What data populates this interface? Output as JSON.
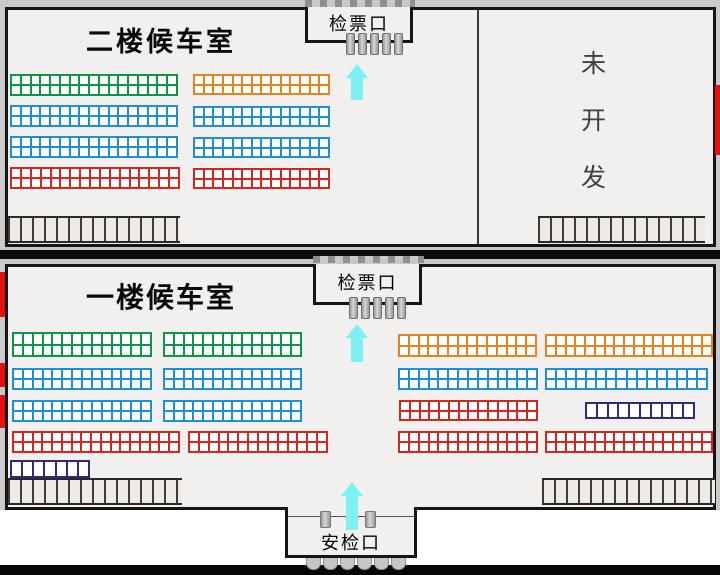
{
  "colors": {
    "green": "#0a9848",
    "orange": "#e7831c",
    "blue": "#1c8fd6",
    "red": "#d7261f",
    "purple": "#33297f",
    "cyan_arrow": "#7df1f1",
    "exit_red": "#e51010",
    "floor_bg": "#f1f0ee",
    "wall": "#151515"
  },
  "icons": {
    "direction": "up-arrow-icon",
    "turnstile": "turnstile-pillar-icon",
    "stairs": "stairs-hatch-icon"
  },
  "floor2": {
    "title": "二楼候车室",
    "gate": {
      "label": "检票口",
      "turnstiles": 5
    },
    "undeveloped": [
      "未",
      "开",
      "发"
    ],
    "seat_groups": [
      {
        "color": "green",
        "x": 10,
        "y": 74,
        "w": 168,
        "h": 22,
        "cols": 17,
        "rows": 2
      },
      {
        "color": "orange",
        "x": 193,
        "y": 74,
        "w": 137,
        "h": 21,
        "cols": 14,
        "rows": 2
      },
      {
        "color": "blue",
        "x": 10,
        "y": 105,
        "w": 168,
        "h": 22,
        "cols": 17,
        "rows": 2
      },
      {
        "color": "blue",
        "x": 193,
        "y": 106,
        "w": 137,
        "h": 21,
        "cols": 14,
        "rows": 2
      },
      {
        "color": "blue",
        "x": 10,
        "y": 136,
        "w": 168,
        "h": 22,
        "cols": 17,
        "rows": 2
      },
      {
        "color": "blue",
        "x": 193,
        "y": 137,
        "w": 137,
        "h": 21,
        "cols": 14,
        "rows": 2
      },
      {
        "color": "red",
        "x": 10,
        "y": 167,
        "w": 170,
        "h": 22,
        "cols": 17,
        "rows": 2
      },
      {
        "color": "red",
        "x": 193,
        "y": 168,
        "w": 137,
        "h": 21,
        "cols": 14,
        "rows": 2
      }
    ]
  },
  "floor1": {
    "title": "一楼候车室",
    "gate": {
      "label": "检票口",
      "turnstiles": 5
    },
    "security": {
      "label": "安检口",
      "pillars": 2,
      "scallops": 6
    },
    "seat_groups": [
      {
        "color": "green",
        "x": 12,
        "y": 332,
        "w": 140,
        "h": 25,
        "cols": 14,
        "rows": 2
      },
      {
        "color": "green",
        "x": 163,
        "y": 332,
        "w": 139,
        "h": 25,
        "cols": 14,
        "rows": 2
      },
      {
        "color": "orange",
        "x": 398,
        "y": 334,
        "w": 139,
        "h": 23,
        "cols": 14,
        "rows": 2
      },
      {
        "color": "orange",
        "x": 545,
        "y": 334,
        "w": 168,
        "h": 23,
        "cols": 17,
        "rows": 2
      },
      {
        "color": "blue",
        "x": 12,
        "y": 368,
        "w": 140,
        "h": 22,
        "cols": 14,
        "rows": 2
      },
      {
        "color": "blue",
        "x": 163,
        "y": 368,
        "w": 139,
        "h": 22,
        "cols": 14,
        "rows": 2
      },
      {
        "color": "blue",
        "x": 398,
        "y": 368,
        "w": 140,
        "h": 22,
        "cols": 14,
        "rows": 2
      },
      {
        "color": "blue",
        "x": 545,
        "y": 368,
        "w": 163,
        "h": 22,
        "cols": 16,
        "rows": 2
      },
      {
        "color": "blue",
        "x": 12,
        "y": 400,
        "w": 140,
        "h": 22,
        "cols": 14,
        "rows": 2
      },
      {
        "color": "blue",
        "x": 163,
        "y": 400,
        "w": 139,
        "h": 22,
        "cols": 14,
        "rows": 2
      },
      {
        "color": "red",
        "x": 399,
        "y": 400,
        "w": 139,
        "h": 21,
        "cols": 14,
        "rows": 2
      },
      {
        "color": "purple",
        "x": 585,
        "y": 402,
        "w": 110,
        "h": 17,
        "cols": 10,
        "rows": 1
      },
      {
        "color": "red",
        "x": 12,
        "y": 431,
        "w": 168,
        "h": 22,
        "cols": 17,
        "rows": 2
      },
      {
        "color": "red",
        "x": 188,
        "y": 431,
        "w": 140,
        "h": 22,
        "cols": 14,
        "rows": 2
      },
      {
        "color": "red",
        "x": 398,
        "y": 431,
        "w": 140,
        "h": 22,
        "cols": 14,
        "rows": 2
      },
      {
        "color": "red",
        "x": 545,
        "y": 431,
        "w": 168,
        "h": 22,
        "cols": 17,
        "rows": 2
      },
      {
        "color": "purple",
        "x": 10,
        "y": 460,
        "w": 80,
        "h": 18,
        "cols": 7,
        "rows": 1
      }
    ]
  }
}
